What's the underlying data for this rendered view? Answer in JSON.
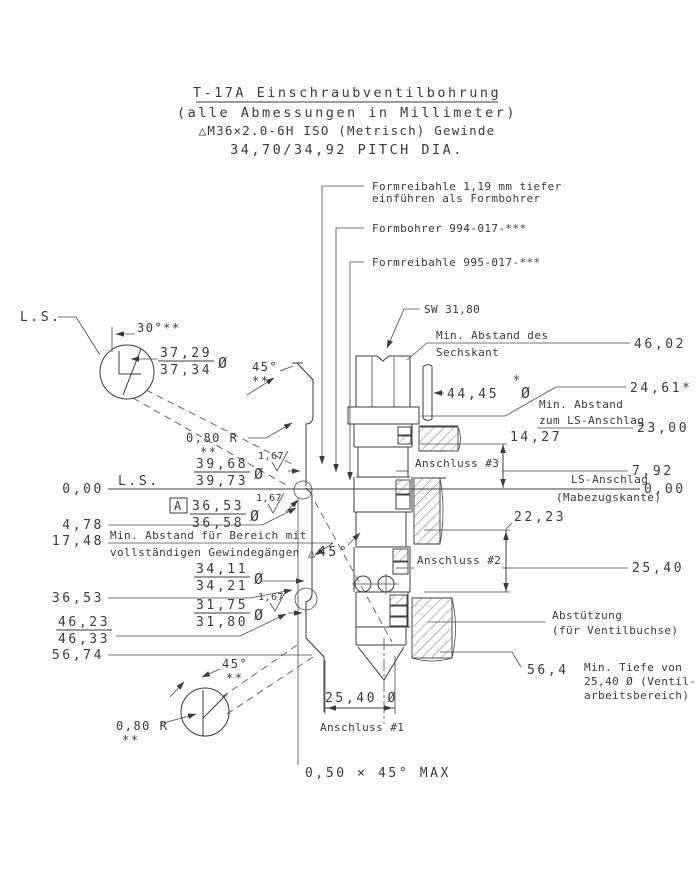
{
  "title": {
    "line1": "T-17A Einschraubventilbohrung",
    "line2": "(alle Abmessungen in Millimeter)",
    "line3": "△M36×2.0-6H ISO (Metrisch) Gewinde",
    "line4": "34,70/34,92 PITCH DIA."
  },
  "callouts": {
    "reamer_depth_line1": "Formreibahle 1,19 mm tiefer",
    "reamer_depth_line2": "einführen als Formbohrer",
    "form_drill": "Formbohrer 994-017-***",
    "form_reamer": "Formreibahle 995-017-***",
    "hex_size": "SW 31,80",
    "chamfer_max": "0,50 × 45° MAX"
  },
  "symbols": {
    "diameter": "Ø",
    "asterisk": "*",
    "double_star": "**",
    "deg45": "45°",
    "deg30_stars": "30°**",
    "radius_080": "0,80 R",
    "roughness": "1,67",
    "triangle": "△",
    "datum": "A",
    "ls": "L.S."
  },
  "left_dims": {
    "d37_upper": "37,29",
    "d37_lower": "37,34",
    "d39_upper": "39,68",
    "d39_lower": "39,73",
    "zero": "0,00",
    "d36_upper": "36,53",
    "d36_lower": "36,58",
    "v478": "4,78",
    "v1748": "17,48",
    "thread_note_line1": "Min. Abstand für Bereich mit",
    "thread_note_line2": "vollständigen Gewindegängen",
    "d34_upper": "34,11",
    "d34_lower": "34,21",
    "v3653": "36,53",
    "d31_upper": "31,75",
    "d31_lower": "31,80",
    "d46_upper": "46,23",
    "d46_lower": "46,33",
    "v5674": "56,74"
  },
  "right_dims": {
    "hex_clear_line1": "Min. Abstand des",
    "hex_clear_line2": "Sechskant",
    "hex_clear_value": "46,02",
    "v2461": "24,61*",
    "ls_clear_line1": "Min. Abstand",
    "ls_clear_line2": "zum LS-Anschlag",
    "ls_clear_value": "23,00",
    "v1427": "14,27",
    "port3": "Anschluss #3",
    "v792": "7,92",
    "ls_edge_line1": "LS-Anschlag",
    "ls_edge_line2": "(Mabezugskante)",
    "ls_edge_value": "0,00",
    "v2223": "22,23",
    "port2": "Anschluss #2",
    "v2540": "25,40",
    "support_line1": "Abstützung",
    "support_line2": "(für Ventilbuchse)",
    "depth_value": "56,4",
    "depth_note_line1": "Min. Tiefe von",
    "depth_note_line2": "25,40 Ø (Ventil-",
    "depth_note_line3": "arbeitsbereich)",
    "washer_dia": "44,45"
  },
  "bottom": {
    "working_dia": "25,40 Ø",
    "port1": "Anschluss #1"
  }
}
